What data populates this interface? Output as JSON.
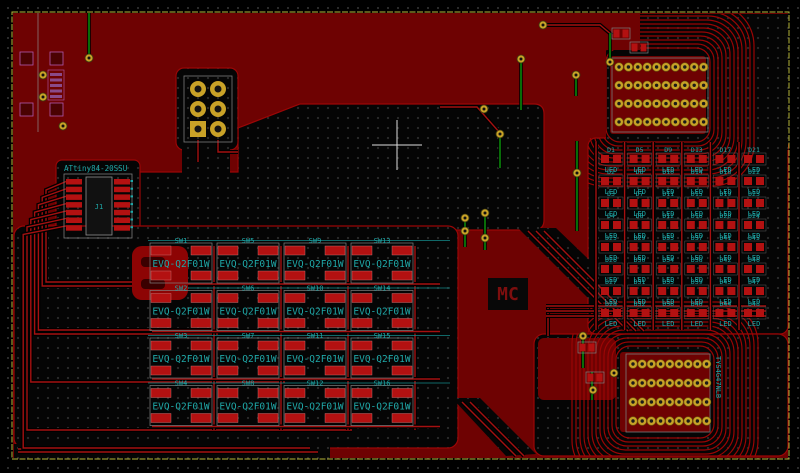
{
  "canvas": {
    "width": 800,
    "height": 473
  },
  "colors": {
    "background": "#000000",
    "copper_pour": "#6E0202",
    "trace_red": "#A41010",
    "trace_green": "#0B9A0B",
    "pad_red": "#B31111",
    "pad_gold": "#C9A227",
    "silk_teal": "#1FA8A8",
    "board_edge": "#B8B83A",
    "courtyard_gray": "#7A7A7A",
    "fab_magenta": "#B05AB0"
  },
  "mcu": {
    "ref": "J1",
    "value": "ATtiny84-20SSU"
  },
  "logo": {
    "text": "MC"
  },
  "switch_matrix": {
    "value": "EVQ-Q2F01W",
    "rows": 4,
    "cols": 4,
    "refs_row_major": [
      "SW1",
      "SW5",
      "SW9",
      "SW13",
      "SW2",
      "SW6",
      "SW10",
      "SW14",
      "SW3",
      "SW7",
      "SW11",
      "SW15",
      "SW4",
      "SW8",
      "SW12",
      "SW16"
    ]
  },
  "led_matrix": {
    "value": "LED",
    "rows": 8,
    "cols": 6,
    "refs_row_major": [
      "D1",
      "D5",
      "D9",
      "D13",
      "D17",
      "D21",
      "D2",
      "D6",
      "D10",
      "D14",
      "D18",
      "D22",
      "D3",
      "D7",
      "D11",
      "D15",
      "D19",
      "D23",
      "D4",
      "D8",
      "D12",
      "D16",
      "D20",
      "D24",
      "D25",
      "D29",
      "D33",
      "D37",
      "D41",
      "D45",
      "D26",
      "D30",
      "D34",
      "D38",
      "D42",
      "D46",
      "D27",
      "D31",
      "D35",
      "D39",
      "D43",
      "D47",
      "D28",
      "D32",
      "D36",
      "D40",
      "D44",
      "D48"
    ]
  },
  "connectors": {
    "top": {
      "pad_rows": 4,
      "pad_cols": 10
    },
    "bottom": {
      "pad_rows": 4,
      "pad_cols": 9,
      "label": "TYS4G47NLB"
    }
  },
  "isp_header": {
    "pad_rows": 3,
    "pad_cols": 2
  }
}
